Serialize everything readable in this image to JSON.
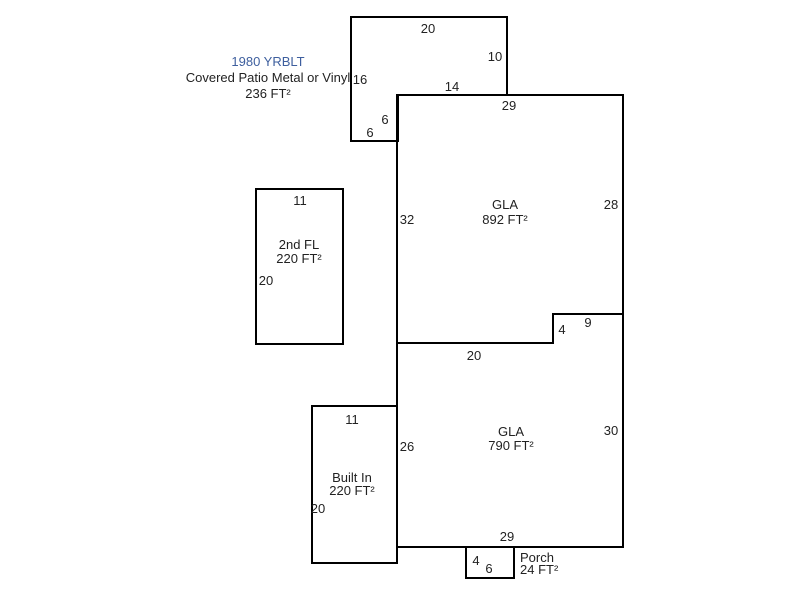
{
  "colors": {
    "background": "#ffffff",
    "outline": "#000000",
    "dimension_text": "#222222",
    "yrblt_blue": "#3e5f9e"
  },
  "areas": {
    "covered_patio": {
      "yrblt": "1980 YRBLT",
      "name": "Covered Patio Metal or Vinyl",
      "area": "236 FT²",
      "dims": {
        "top": "20",
        "right": "10",
        "left": "16",
        "inner": "14",
        "step_v": "6",
        "step_h": "6"
      }
    },
    "gla_upper": {
      "name": "GLA",
      "area": "892 FT²",
      "dims": {
        "top": "29",
        "right": "28",
        "left": "32",
        "step_h": "9",
        "step_v": "4",
        "bottom": "20"
      }
    },
    "second_floor": {
      "name": "2nd FL",
      "area": "220 FT²",
      "dims": {
        "top": "11",
        "left": "20"
      }
    },
    "gla_lower": {
      "name": "GLA",
      "area": "790 FT²",
      "dims": {
        "left": "26",
        "right": "30",
        "bottom": "29"
      }
    },
    "built_in": {
      "name": "Built In",
      "area": "220 FT²",
      "dims": {
        "top": "11",
        "left": "20"
      }
    },
    "porch": {
      "name": "Porch",
      "area": "24 FT²",
      "dims": {
        "left": "4",
        "bottom": "6"
      }
    }
  }
}
